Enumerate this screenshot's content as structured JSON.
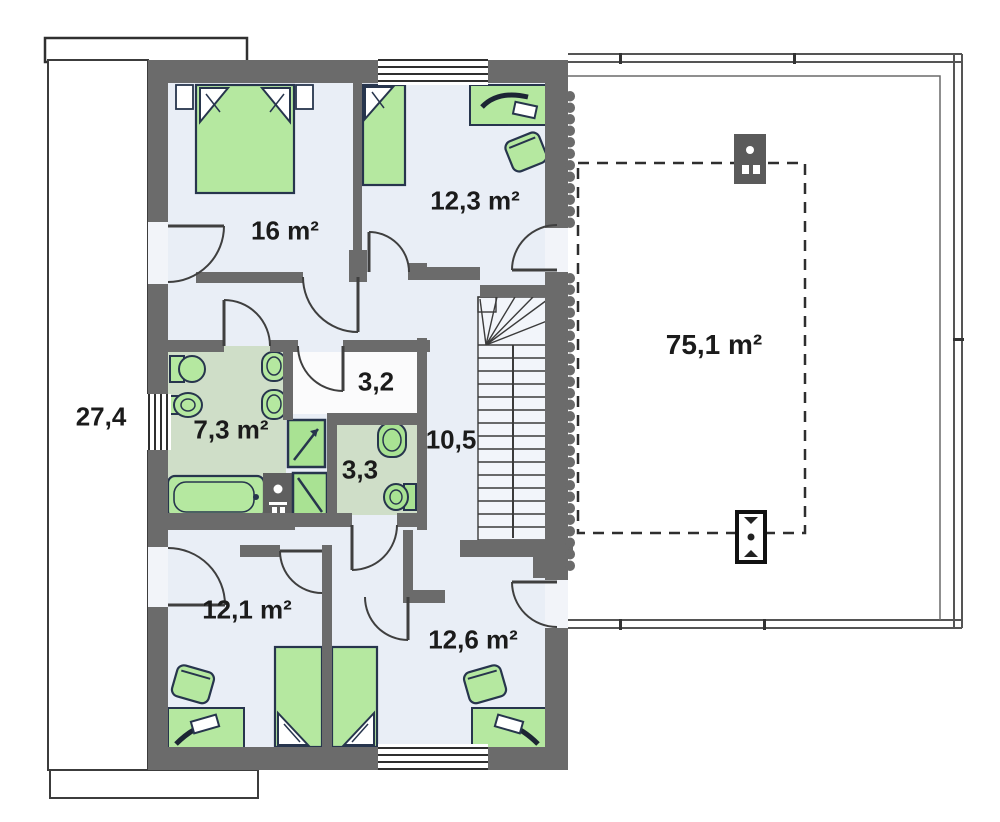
{
  "plan_title": "Attic floor plan",
  "colors": {
    "wall": "#6b6b6b",
    "floor": "#e9eef6",
    "wet_room_floor": "#cfdec8",
    "furniture_green": "#b5e8a0",
    "furniture_outline": "#27354d",
    "label_text": "#1b1b1b",
    "terrace_line": "#555555"
  },
  "rooms": [
    {
      "name": "bedroom-top-left",
      "label": "16 m²"
    },
    {
      "name": "bedroom-top-right",
      "label": "12,3 m²"
    },
    {
      "name": "balcony-left",
      "label": "27,4"
    },
    {
      "name": "closet",
      "label": "3,2"
    },
    {
      "name": "bathroom",
      "label": "7,3 m²"
    },
    {
      "name": "wc",
      "label": "3,3"
    },
    {
      "name": "hallway",
      "label": "10,5"
    },
    {
      "name": "bedroom-bottom-left",
      "label": "12,1 m²"
    },
    {
      "name": "bedroom-bottom-right",
      "label": "12,6 m²"
    },
    {
      "name": "terrace",
      "label": "75,1 m²"
    }
  ]
}
